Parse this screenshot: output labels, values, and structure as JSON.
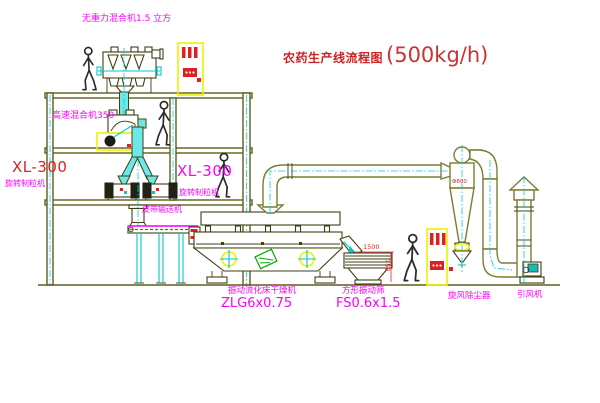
{
  "title": {
    "zh": "农药生产线流程图",
    "capacity": "(500kg/h)"
  },
  "labels": {
    "gravity_mixer": "无重力混合机1.5 立方",
    "high_speed_mixer": "高速混合机350",
    "xl300_left": "XL-300",
    "granulator_left": "旋转制粒机",
    "xl300_right": "XL-300",
    "granulator_right": "旋转制粒机",
    "belt_conveyor": "皮带输送机",
    "fluid_bed_dryer": "振动流化床干燥机",
    "fluid_bed_model": "ZLG6x0.75",
    "square_sieve": "方形振动筛",
    "square_sieve_model": "FS0.6x1.5",
    "cyclone": "旋风除尘器",
    "induced_fan": "引风机"
  },
  "dimensions": {
    "sieve_length": "1500",
    "sieve_height": "750",
    "cyclone_marking": "Φ800"
  },
  "colors": {
    "label_magenta": "#ff00ff",
    "title_red": "#cc2222",
    "dimension_red": "#e02020",
    "structure_olive": "#5d5d20",
    "duct_olive": "#7c7c34",
    "centerline_cyan": "#00d0d0",
    "cabinet_yellow": "#f0f000",
    "belt_green": "#00aa00"
  }
}
